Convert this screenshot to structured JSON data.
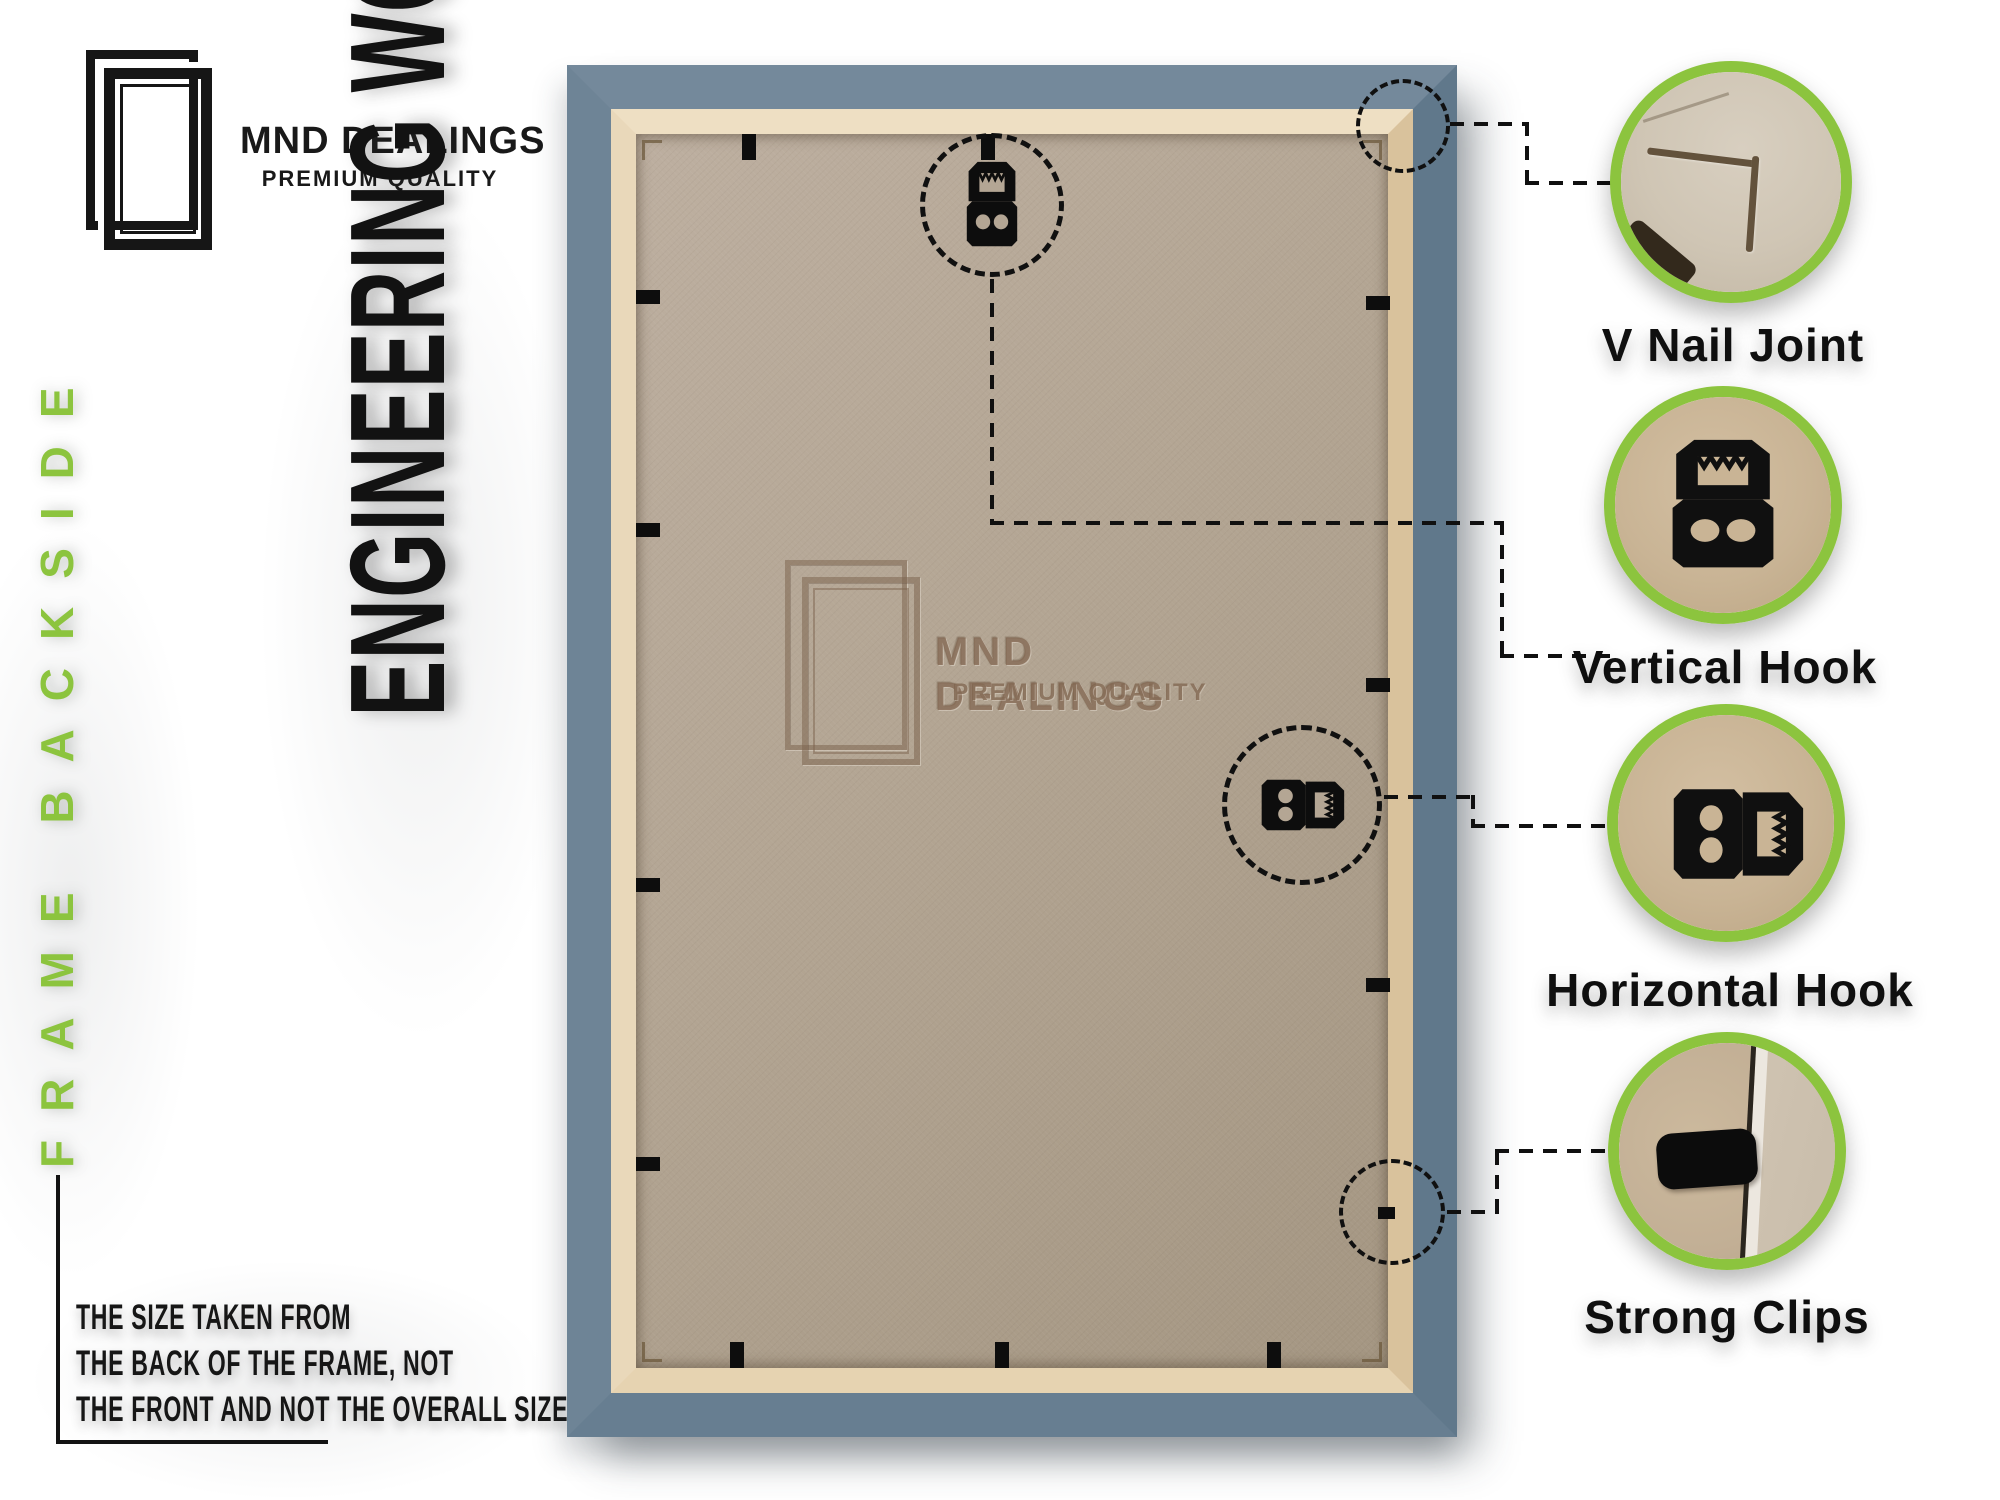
{
  "brand": {
    "name": "MND DEALINGS",
    "tagline": "PREMIUM QUALITY"
  },
  "left_panel": {
    "side_label": "FRAME BACKSIDE",
    "material_label": "ENGINEERING WOOD",
    "note_lines": [
      "THE SIZE TAKEN FROM",
      "THE BACK OF THE FRAME, NOT",
      "THE FRONT AND NOT THE OVERALL SIZE."
    ]
  },
  "watermark": {
    "name": "MND DEALINGS",
    "tagline": "PREMIUM QUALITY"
  },
  "callouts": [
    {
      "id": "v-nail-joint",
      "label": "V Nail Joint"
    },
    {
      "id": "vertical-hook",
      "label": "Vertical Hook"
    },
    {
      "id": "horizontal-hook",
      "label": "Horizontal Hook"
    },
    {
      "id": "strong-clips",
      "label": "Strong Clips"
    }
  ],
  "colors": {
    "accent_green": "#8cc43e",
    "frame_blue": "#6d8396",
    "frame_lip_cream": "#e9d8ba",
    "board_tan": "#b3a593",
    "label_black": "#0f0f0f"
  }
}
